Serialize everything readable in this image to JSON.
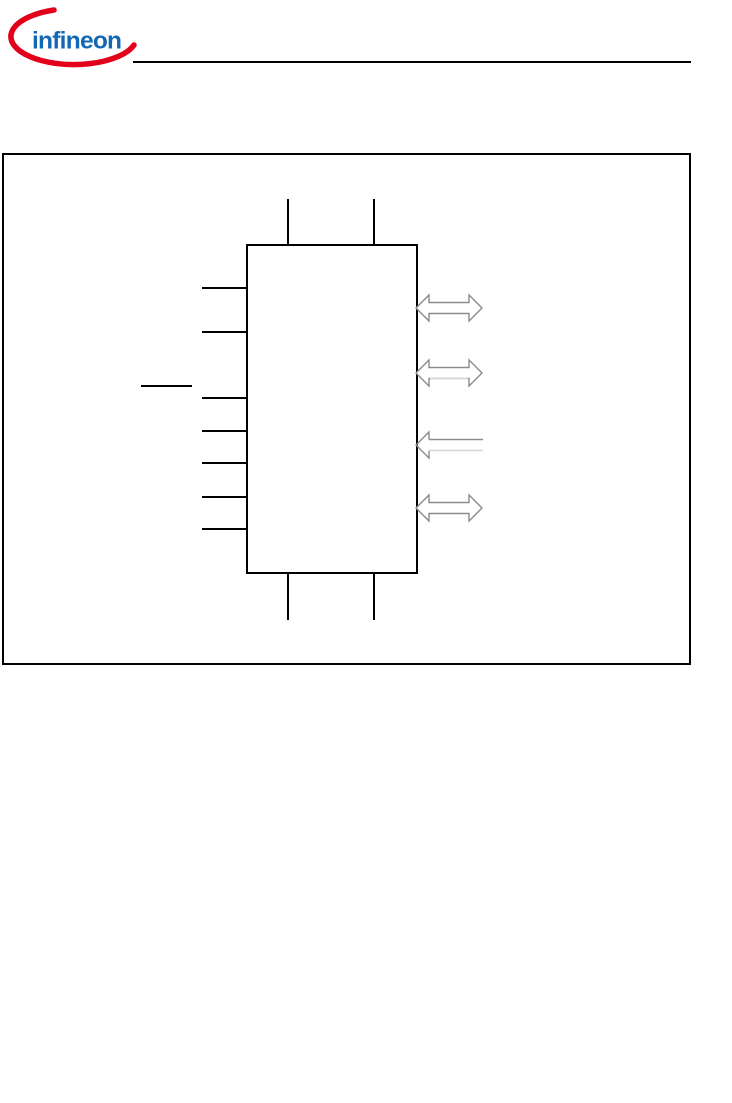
{
  "logo": {
    "wordmark": "infineon"
  },
  "colors": {
    "page_bg": "#ffffff",
    "rule": "#000000",
    "frame": "#000000",
    "block_border": "#000000",
    "pin": "#000000",
    "arrow_outline": "#8c8c8c",
    "arrow_light": "#d9d9d9",
    "arrow_fill": "#ffffff",
    "logo_blue": "#1268b2",
    "logo_red": "#e2001a"
  },
  "figure": {
    "block_pin_counts": {
      "left_pins": 7,
      "top_pins": 2,
      "bottom_pins": 2
    },
    "arrows": [
      {
        "type": "bidirectional"
      },
      {
        "type": "bidirectional"
      },
      {
        "type": "input-left"
      },
      {
        "type": "bidirectional"
      }
    ]
  }
}
